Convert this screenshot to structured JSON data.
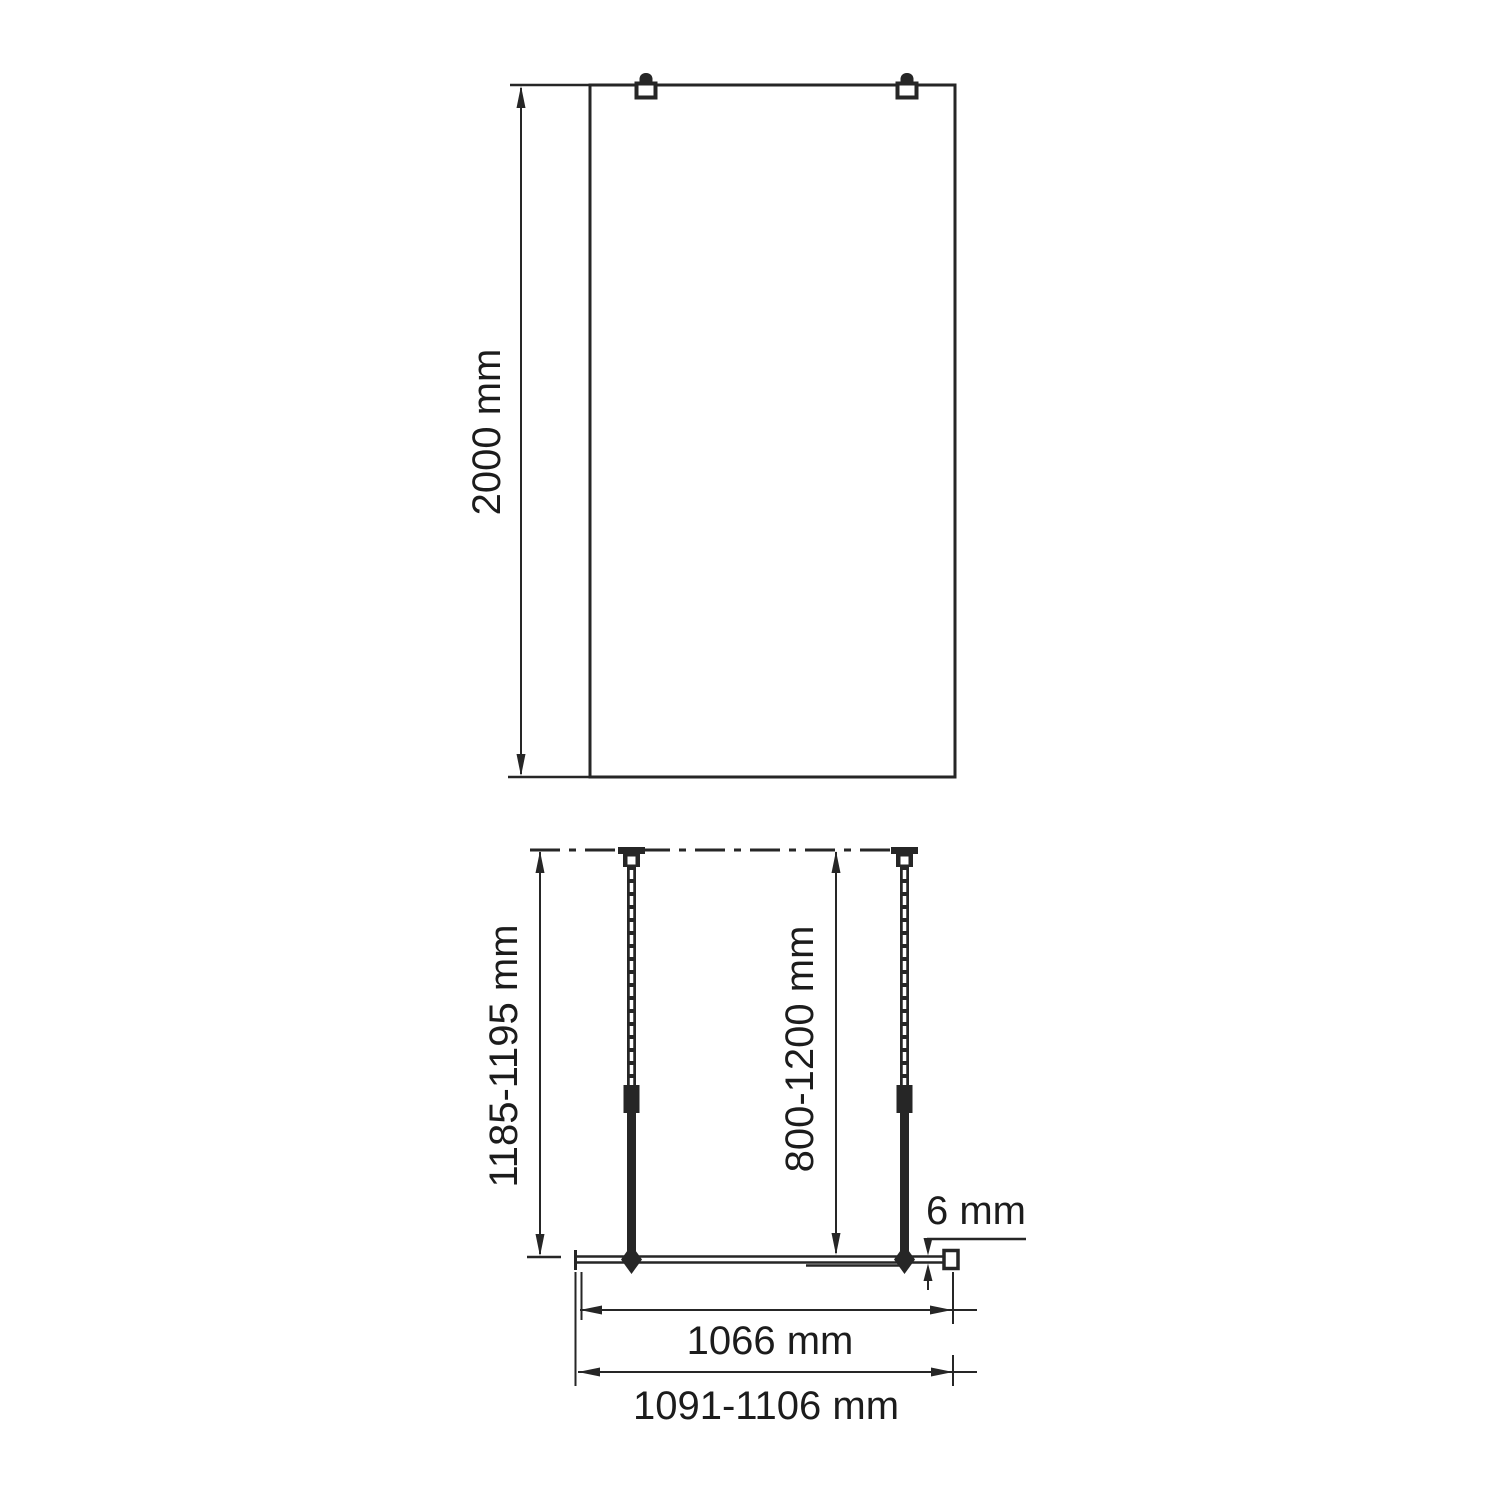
{
  "page": {
    "background_color": "#ffffff",
    "line_color": "#262626",
    "description": "Technical installation drawing of a walk-in shower glass panel: front elevation (top) and plan view with support bars (bottom)"
  },
  "front_view": {
    "name": "glass-panel-front-elevation",
    "height_label": "2000 mm"
  },
  "plan_view": {
    "name": "installation-plan-view",
    "depth_label": "1185-1195 mm",
    "support_bar_range_label": "800-1200 mm",
    "glass_thickness_label": "6 mm",
    "glass_width_label": "1066 mm",
    "overall_width_label": "1091-1106 mm"
  }
}
